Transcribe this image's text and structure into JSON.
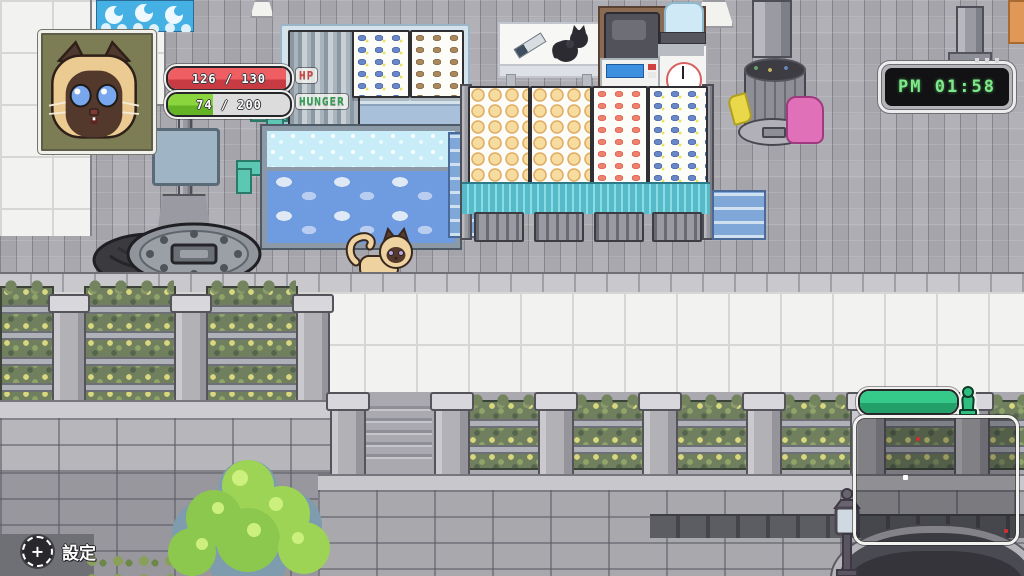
{
  "hud": {
    "portrait": {
      "icon": "siamese-cat-portrait",
      "frame_color": "#f0f0ec",
      "background_color": "#7d7d55"
    },
    "hp_bar": {
      "label": "HP",
      "value": "126 / 130",
      "current": 126,
      "max": 130,
      "fill_color": "#e5494f",
      "label_color": "#cf4440"
    },
    "hunger_bar": {
      "label": "HUNGER",
      "value": "74 / 200",
      "current": 74,
      "max": 200,
      "fill_color": "#7bc836",
      "label_color": "#2f9e52"
    },
    "clock": {
      "time": "PM 01:58",
      "text_color": "#7fe98a",
      "screen_color": "#121214"
    },
    "settings_button": {
      "glyph": "+",
      "label": "設定"
    },
    "territory_bar": {
      "percent": 100,
      "fill_color": "#2fbe80",
      "icon": "hydrant-marker-icon"
    },
    "map_overlay": {
      "border_color": "#f2f2ee",
      "player_dot_color": "#ffffff",
      "marker_dot_color": "#c83232"
    }
  },
  "scene_objects": [
    "wave-banner-sign",
    "hanging-fish-display",
    "blue-fish-display",
    "dried-fish-display",
    "live-fish-tank",
    "teal-water-pipe",
    "street-sign-post",
    "prep-table-with-knife",
    "black-cat",
    "cash-register",
    "kitchen-scale",
    "water-jug",
    "market-stall-boards",
    "teal-stall-cloth",
    "stall-stools",
    "trash-can",
    "pink-trash-bag",
    "open-manhole",
    "siamese-cat-player",
    "bridge-planters",
    "bridge-railing",
    "stone-wall",
    "bridge-arch",
    "street-lamp",
    "green-tree",
    "hanging-lamp",
    "orange-crate"
  ]
}
